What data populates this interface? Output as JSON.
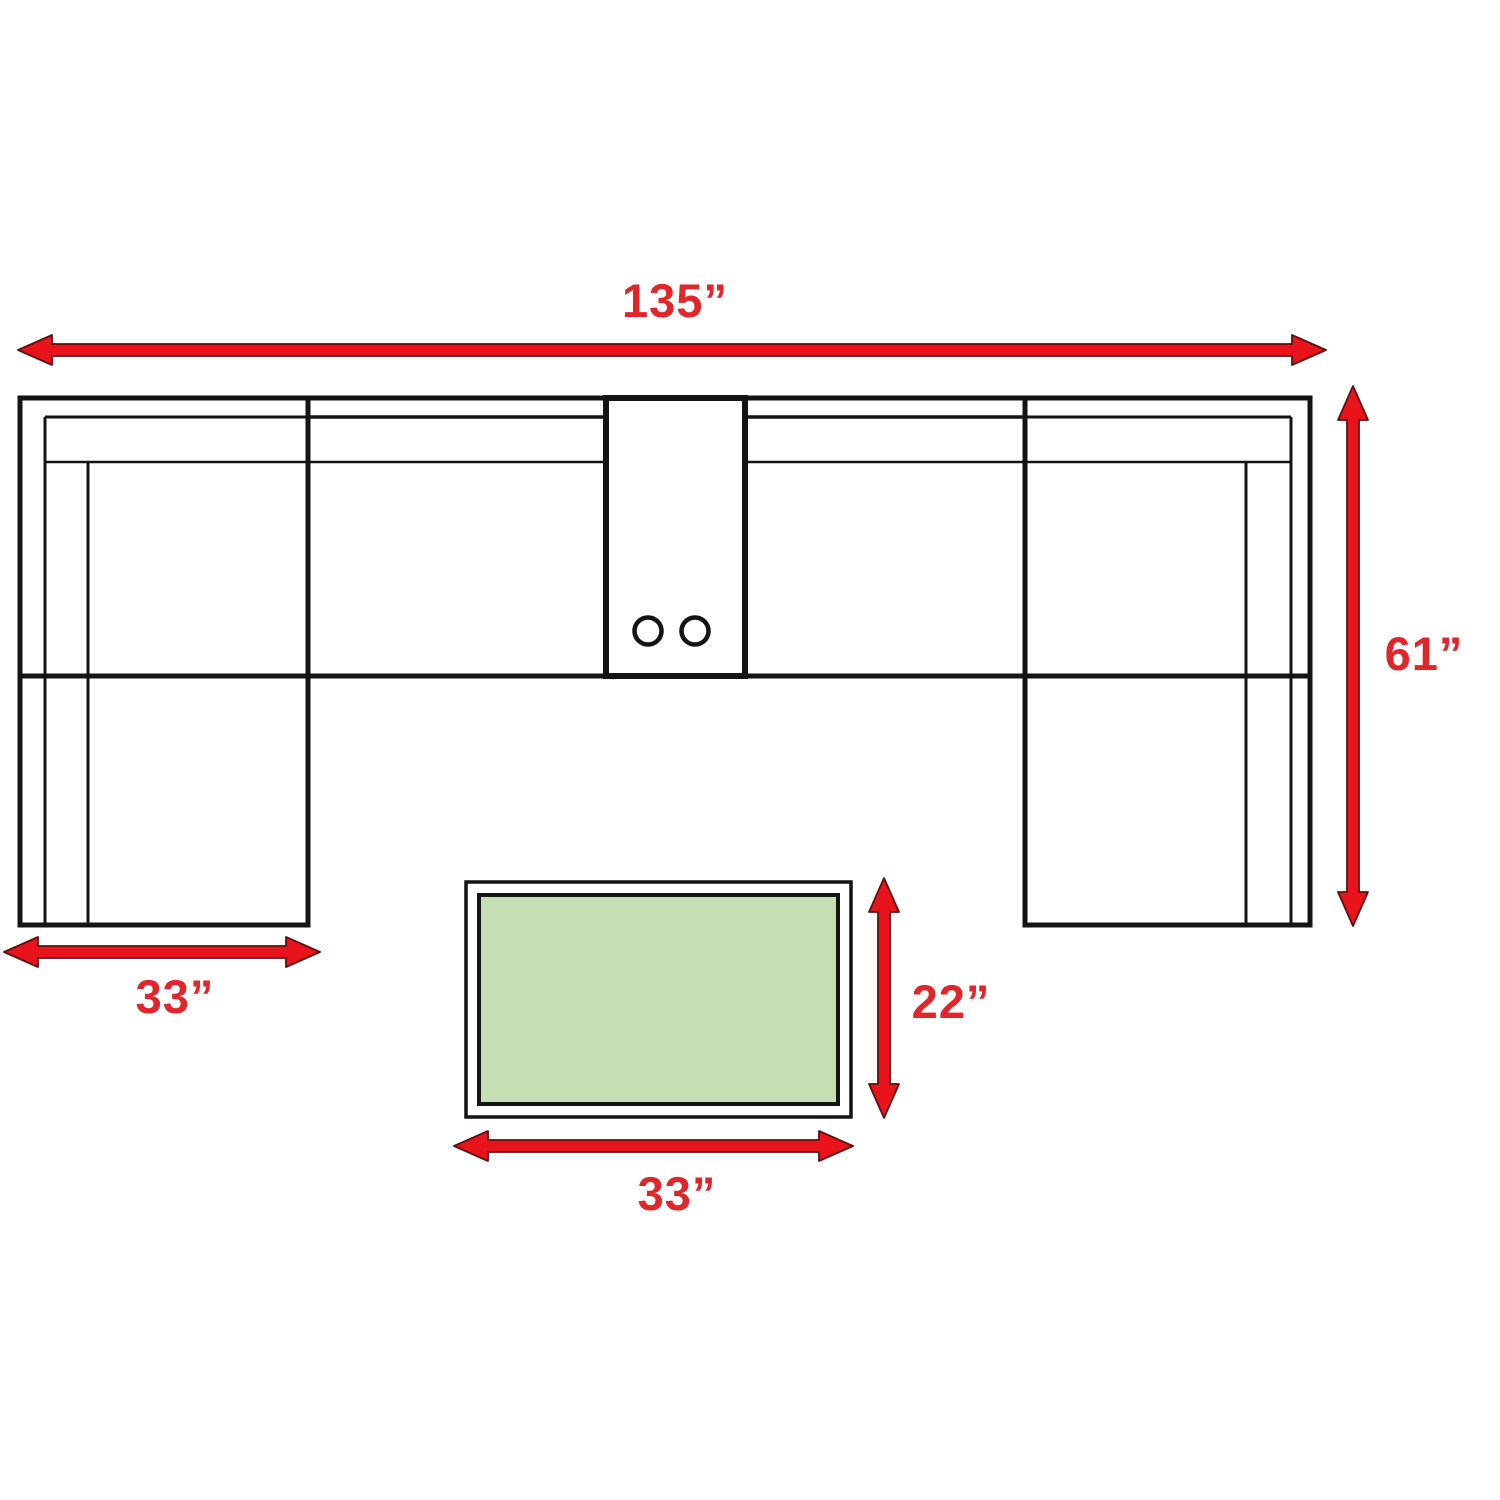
{
  "diagram": {
    "labels": {
      "sofa_width": "135”",
      "sofa_depth": "61”",
      "chaise_width": "33”",
      "table_depth": "22”",
      "table_width": "33”"
    },
    "colors": {
      "line": "#141414",
      "arrow_fill": "#e9131b",
      "arrow_edge": "#5d1013",
      "label_red": "#e0262b",
      "table_fill": "#c6deb4",
      "background": "#ffffff"
    }
  }
}
